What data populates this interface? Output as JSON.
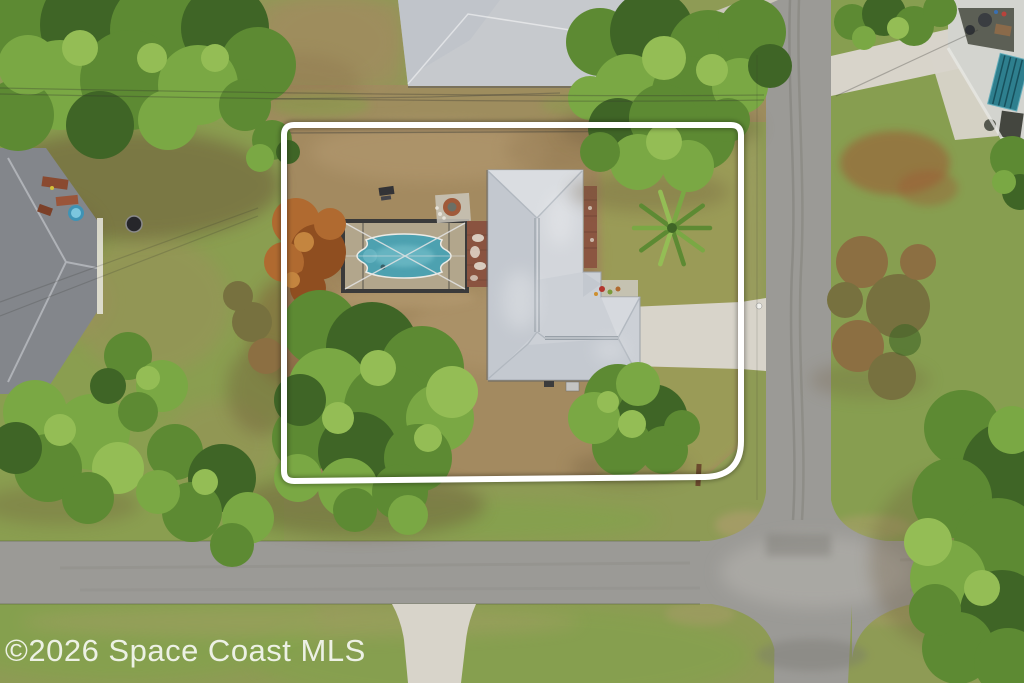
{
  "watermark": {
    "text": "©2026 Space Coast MLS"
  },
  "colors": {
    "grass_base": "#8e9b55",
    "grass_left": "#87a04c",
    "grass_bright": "#7aa845",
    "grass_right": "#82a04c",
    "grass_front": "#99a055",
    "lot_dirt": "#a38a60",
    "dirt_dark": "#8a7048",
    "dirt_shadow": "#6e5a3a",
    "dirt_red": "#9e5a35",
    "sand_light": "#b89e74",
    "road": "#9b9a96",
    "road_light": "#b6b4af",
    "road_dark": "#76756e",
    "concrete": "#d8d4ca",
    "concrete_dim": "#cac6bb",
    "roof_main": "#ccd0d6",
    "roof_light": "#dfe2e6",
    "roof_shade": "#b9bfc7",
    "neighbor_roof": "#c6c9cd",
    "left_roof": "#83868b",
    "left_roof_line": "#babdc2",
    "white_wall": "#d3d4cf",
    "teal_structure": "#2e7f8e",
    "pool_water": "#4da1b0",
    "pool_water_light": "#7cc4cf",
    "pool_deck": "#b2a68c",
    "enclosure_frame": "#3a3a3a",
    "screen_line": "#e4e4e4",
    "paver_brick": "#8a5340",
    "tree_dark": "#3f6526",
    "tree_mid": "#5d8a33",
    "tree_light": "#7aa844",
    "tree_bright": "#94bd55",
    "tree_brown": "#8c6f42",
    "tree_olive": "#77713f",
    "tree_orange": "#b06a30",
    "tree_orange_dark": "#8f4e20",
    "tree_orange_light": "#c4853f",
    "boundary": "#ffffff",
    "wire": "#33332f",
    "watermark": "rgba(255,255,255,0.85)"
  }
}
